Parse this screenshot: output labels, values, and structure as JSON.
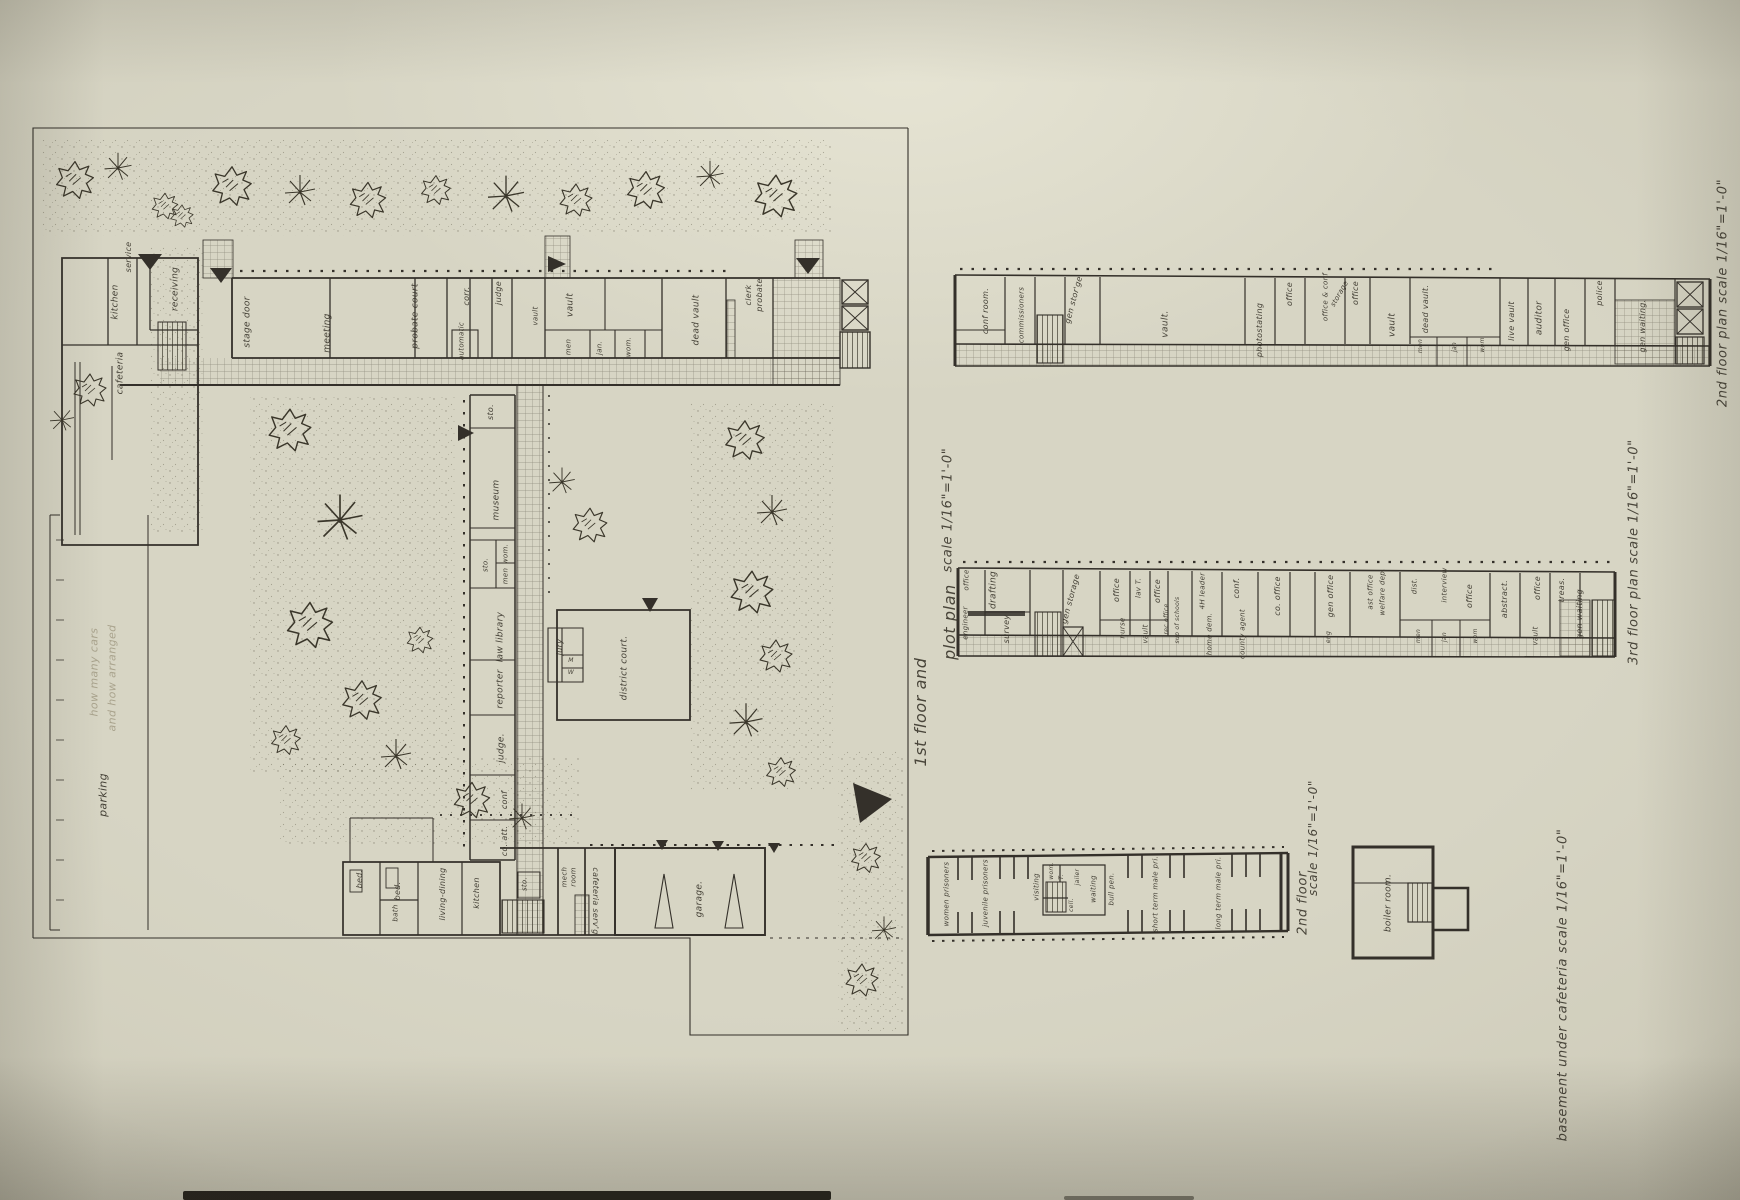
{
  "palette": {
    "paper": "#d7d5c4",
    "ink": "#38342a",
    "pencil": "#a29b84"
  },
  "site_plan": {
    "name": "site and first floor plan",
    "captions": [
      {
        "t": "1st floor and",
        "x": 921,
        "y": 712,
        "fs": 16
      },
      {
        "t": "plot plan",
        "x": 950,
        "y": 622,
        "fs": 16
      },
      {
        "t": "scale 1/16\"=1'-0\"",
        "x": 948,
        "y": 510,
        "fs": 13
      }
    ],
    "pencil_notes": [
      {
        "t": "how many cars",
        "x": 94,
        "y": 672,
        "fs": 11
      },
      {
        "t": "and how arranged",
        "x": 112,
        "y": 678,
        "fs": 11
      }
    ],
    "labels": [
      {
        "t": "service",
        "x": 129,
        "y": 257,
        "fs": 8
      },
      {
        "t": "kitchen",
        "x": 116,
        "y": 302
      },
      {
        "t": "receiving",
        "x": 176,
        "y": 289
      },
      {
        "t": "cafeteria",
        "x": 121,
        "y": 373
      },
      {
        "t": "stage door",
        "x": 248,
        "y": 322
      },
      {
        "t": "meeting",
        "x": 328,
        "y": 333
      },
      {
        "t": "probate court",
        "x": 416,
        "y": 316
      },
      {
        "t": "corr.",
        "x": 467,
        "y": 296,
        "fs": 8
      },
      {
        "t": "automatic",
        "x": 462,
        "y": 341,
        "fs": 7
      },
      {
        "t": "judge",
        "x": 499,
        "y": 293,
        "fs": 8
      },
      {
        "t": "vault",
        "x": 536,
        "y": 316,
        "fs": 7
      },
      {
        "t": "vault",
        "x": 571,
        "y": 305
      },
      {
        "t": "men",
        "x": 569,
        "y": 347,
        "fs": 7
      },
      {
        "t": "jan.",
        "x": 600,
        "y": 348,
        "fs": 7
      },
      {
        "t": "wom.",
        "x": 629,
        "y": 347,
        "fs": 7
      },
      {
        "t": "dead vault",
        "x": 697,
        "y": 320
      },
      {
        "t": "clerk",
        "x": 749,
        "y": 295,
        "fs": 8
      },
      {
        "t": "probate",
        "x": 760,
        "y": 295,
        "fs": 8
      },
      {
        "t": "sto.",
        "x": 491,
        "y": 412,
        "fs": 8
      },
      {
        "t": "museum",
        "x": 497,
        "y": 500
      },
      {
        "t": "wom.",
        "x": 506,
        "y": 554,
        "fs": 7
      },
      {
        "t": "men",
        "x": 506,
        "y": 576,
        "fs": 7
      },
      {
        "t": "sto.",
        "x": 486,
        "y": 565,
        "fs": 7
      },
      {
        "t": "law library",
        "x": 501,
        "y": 637
      },
      {
        "t": "reporter",
        "x": 501,
        "y": 689
      },
      {
        "t": "judge.",
        "x": 502,
        "y": 748
      },
      {
        "t": "conf",
        "x": 505,
        "y": 800,
        "fs": 8
      },
      {
        "t": "co. att.",
        "x": 505,
        "y": 841,
        "fs": 8
      },
      {
        "t": "jury",
        "x": 560,
        "y": 647,
        "fs": 8
      },
      {
        "t": "M",
        "x": 571,
        "y": 661,
        "fs": 6,
        "r": 0
      },
      {
        "t": "W",
        "x": 571,
        "y": 673,
        "fs": 6,
        "r": 0
      },
      {
        "t": "district court.",
        "x": 625,
        "y": 668
      },
      {
        "t": "bed.",
        "x": 360,
        "y": 879,
        "fs": 8
      },
      {
        "t": "bed.",
        "x": 398,
        "y": 891,
        "fs": 8
      },
      {
        "t": "bath",
        "x": 396,
        "y": 913,
        "fs": 7
      },
      {
        "t": "living-dining",
        "x": 443,
        "y": 894,
        "fs": 8
      },
      {
        "t": "kitchen",
        "x": 477,
        "y": 893,
        "fs": 8
      },
      {
        "t": "sto.",
        "x": 525,
        "y": 884,
        "fs": 7
      },
      {
        "t": "mech",
        "x": 565,
        "y": 877,
        "fs": 7
      },
      {
        "t": "room",
        "x": 574,
        "y": 877,
        "fs": 7
      },
      {
        "t": "cafeteria serv'g",
        "x": 595,
        "y": 901,
        "r": 90,
        "fs": 8
      },
      {
        "t": "garage.",
        "x": 700,
        "y": 899
      },
      {
        "t": "parking",
        "x": 103,
        "y": 795,
        "fs": 11
      }
    ]
  },
  "second_floor_plan": {
    "captions": [
      {
        "t": "2nd floor plan  scale 1/16\"=1'-0\"",
        "x": 1723,
        "y": 293,
        "fs": 13
      }
    ],
    "labels": [
      {
        "t": "conf room.",
        "x": 986,
        "y": 311,
        "fs": 8
      },
      {
        "t": "commissioners",
        "x": 1022,
        "y": 315,
        "fs": 7
      },
      {
        "t": "gen stor'ge",
        "x": 1074,
        "y": 300,
        "r": -75,
        "fs": 8
      },
      {
        "t": "vault.",
        "x": 1166,
        "y": 324
      },
      {
        "t": "photostating",
        "x": 1260,
        "y": 330,
        "fs": 8
      },
      {
        "t": "office",
        "x": 1290,
        "y": 294,
        "fs": 8
      },
      {
        "t": "office & conf",
        "x": 1326,
        "y": 297,
        "fs": 7
      },
      {
        "t": "storage",
        "x": 1340,
        "y": 294,
        "r": -60,
        "fs": 7
      },
      {
        "t": "office",
        "x": 1356,
        "y": 293,
        "fs": 8
      },
      {
        "t": "vault",
        "x": 1393,
        "y": 325
      },
      {
        "t": "dead vault.",
        "x": 1426,
        "y": 309,
        "fs": 8
      },
      {
        "t": "men",
        "x": 1421,
        "y": 346,
        "fs": 6
      },
      {
        "t": "jan",
        "x": 1455,
        "y": 347,
        "fs": 6
      },
      {
        "t": "wom",
        "x": 1483,
        "y": 345,
        "fs": 6
      },
      {
        "t": "live vault",
        "x": 1512,
        "y": 321,
        "fs": 8
      },
      {
        "t": "auditor",
        "x": 1540,
        "y": 318
      },
      {
        "t": "gen office",
        "x": 1567,
        "y": 330,
        "fs": 8
      },
      {
        "t": "police",
        "x": 1600,
        "y": 293,
        "fs": 8
      },
      {
        "t": "gen waiting.",
        "x": 1643,
        "y": 326,
        "fs": 8
      }
    ]
  },
  "third_floor_plan": {
    "captions": [
      {
        "t": "3rd floor plan  scale 1/16\"=1'-0\"",
        "x": 1634,
        "y": 552,
        "fs": 13
      }
    ],
    "labels": [
      {
        "t": "office",
        "x": 967,
        "y": 580,
        "fs": 7
      },
      {
        "t": "engineer",
        "x": 966,
        "y": 623,
        "fs": 7
      },
      {
        "t": "drafting",
        "x": 994,
        "y": 590
      },
      {
        "t": "survey",
        "x": 1007,
        "y": 629,
        "fs": 8
      },
      {
        "t": "gen storage",
        "x": 1071,
        "y": 599,
        "r": -75,
        "fs": 8
      },
      {
        "t": "office",
        "x": 1117,
        "y": 590,
        "fs": 8
      },
      {
        "t": "nurse",
        "x": 1123,
        "y": 628,
        "fs": 7
      },
      {
        "t": "lav T.",
        "x": 1139,
        "y": 588,
        "fs": 7
      },
      {
        "t": "office",
        "x": 1158,
        "y": 591,
        "fs": 8
      },
      {
        "t": "vault",
        "x": 1146,
        "y": 634,
        "fs": 7
      },
      {
        "t": "rec office",
        "x": 1167,
        "y": 619,
        "fs": 6
      },
      {
        "t": "sup of schools",
        "x": 1178,
        "y": 620,
        "fs": 6
      },
      {
        "t": "4H leader",
        "x": 1203,
        "y": 591,
        "fs": 7
      },
      {
        "t": "home dem.",
        "x": 1210,
        "y": 634,
        "fs": 7
      },
      {
        "t": "conf.",
        "x": 1237,
        "y": 588,
        "fs": 8
      },
      {
        "t": "county agent",
        "x": 1243,
        "y": 634,
        "fs": 7
      },
      {
        "t": "co. office",
        "x": 1278,
        "y": 596,
        "fs": 8
      },
      {
        "t": "gen office",
        "x": 1331,
        "y": 596,
        "fs": 8
      },
      {
        "t": "eng",
        "x": 1329,
        "y": 637,
        "fs": 6
      },
      {
        "t": "ast office",
        "x": 1371,
        "y": 592,
        "fs": 7
      },
      {
        "t": "welfare dep.",
        "x": 1383,
        "y": 592,
        "fs": 7
      },
      {
        "t": "dist.",
        "x": 1415,
        "y": 586,
        "fs": 7
      },
      {
        "t": "interview",
        "x": 1445,
        "y": 585,
        "fs": 7
      },
      {
        "t": "office",
        "x": 1470,
        "y": 596,
        "fs": 8
      },
      {
        "t": "men",
        "x": 1419,
        "y": 636,
        "fs": 6
      },
      {
        "t": "jan",
        "x": 1445,
        "y": 637,
        "fs": 6
      },
      {
        "t": "wom",
        "x": 1476,
        "y": 636,
        "fs": 6
      },
      {
        "t": "abstract.",
        "x": 1505,
        "y": 599,
        "fs": 8
      },
      {
        "t": "vault",
        "x": 1536,
        "y": 636,
        "fs": 7
      },
      {
        "t": "office",
        "x": 1538,
        "y": 588,
        "fs": 8
      },
      {
        "t": "treas.",
        "x": 1562,
        "y": 590,
        "fs": 8
      },
      {
        "t": "gen waiting",
        "x": 1580,
        "y": 614,
        "fs": 8
      }
    ]
  },
  "jail_floor_plan": {
    "captions": [
      {
        "t": "2nd floor",
        "x": 1303,
        "y": 903,
        "fs": 13
      },
      {
        "t": "scale 1/16\"=1'-0\"",
        "x": 1313,
        "y": 838,
        "fs": 12
      }
    ],
    "labels": [
      {
        "t": "women prisoners",
        "x": 947,
        "y": 894,
        "fs": 7
      },
      {
        "t": "juvenile prisoners",
        "x": 986,
        "y": 893,
        "fs": 7
      },
      {
        "t": "visiting",
        "x": 1037,
        "y": 887,
        "fs": 7
      },
      {
        "t": "wom.",
        "x": 1052,
        "y": 871,
        "fs": 6
      },
      {
        "t": "T.",
        "x": 1062,
        "y": 877,
        "fs": 6
      },
      {
        "t": "jailer",
        "x": 1078,
        "y": 877,
        "fs": 6
      },
      {
        "t": "cell.",
        "x": 1072,
        "y": 905,
        "fs": 6
      },
      {
        "t": "waiting",
        "x": 1094,
        "y": 889,
        "fs": 7
      },
      {
        "t": "bull pen.",
        "x": 1112,
        "y": 889,
        "fs": 7
      },
      {
        "t": "short term male pri.",
        "x": 1156,
        "y": 894,
        "fs": 7
      },
      {
        "t": "long term male pri.",
        "x": 1219,
        "y": 893,
        "fs": 7
      }
    ]
  },
  "boiler_plan": {
    "captions": [
      {
        "t": "basement under cafeteria  scale 1/16\"=1'-0\"",
        "x": 1563,
        "y": 985,
        "fs": 13
      }
    ],
    "labels": [
      {
        "t": "boiler room.",
        "x": 1389,
        "y": 903,
        "fs": 9
      }
    ]
  }
}
